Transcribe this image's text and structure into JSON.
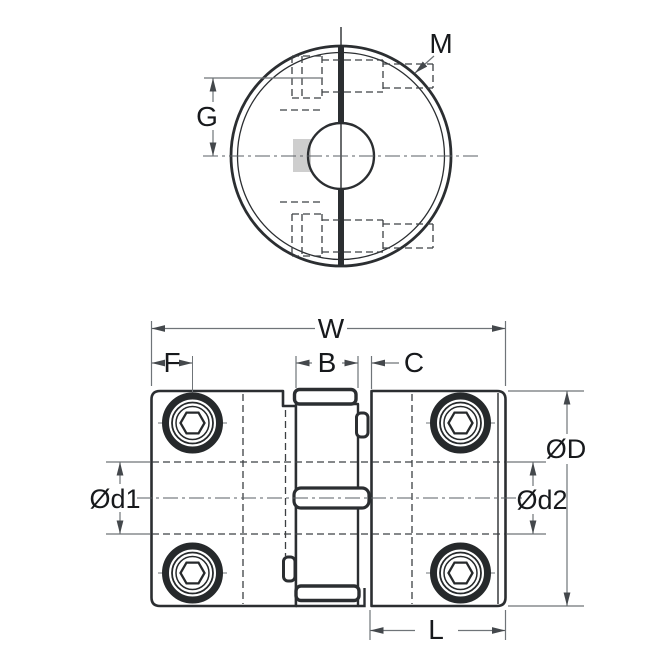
{
  "drawing": {
    "type": "jaw-coupling-technical-drawing",
    "colors": {
      "background": "#ffffff",
      "body_line": "#2b2e31",
      "dimension_line": "#6f7478",
      "hidden_line": "#3c4043",
      "label_text": "#17191c",
      "shade": "#c5c5c5"
    },
    "end_view": {
      "thread_label": "M",
      "screw_offset_label": "G"
    },
    "side_view": {
      "overall_width_label": "W",
      "screw_inset_label": "F",
      "spider_width_label": "B",
      "jaw_gap_label": "C",
      "outer_diameter_label": "ØD",
      "bore_left_label": "Ød1",
      "bore_right_label": "Ød2",
      "hub_length_label": "L"
    }
  }
}
